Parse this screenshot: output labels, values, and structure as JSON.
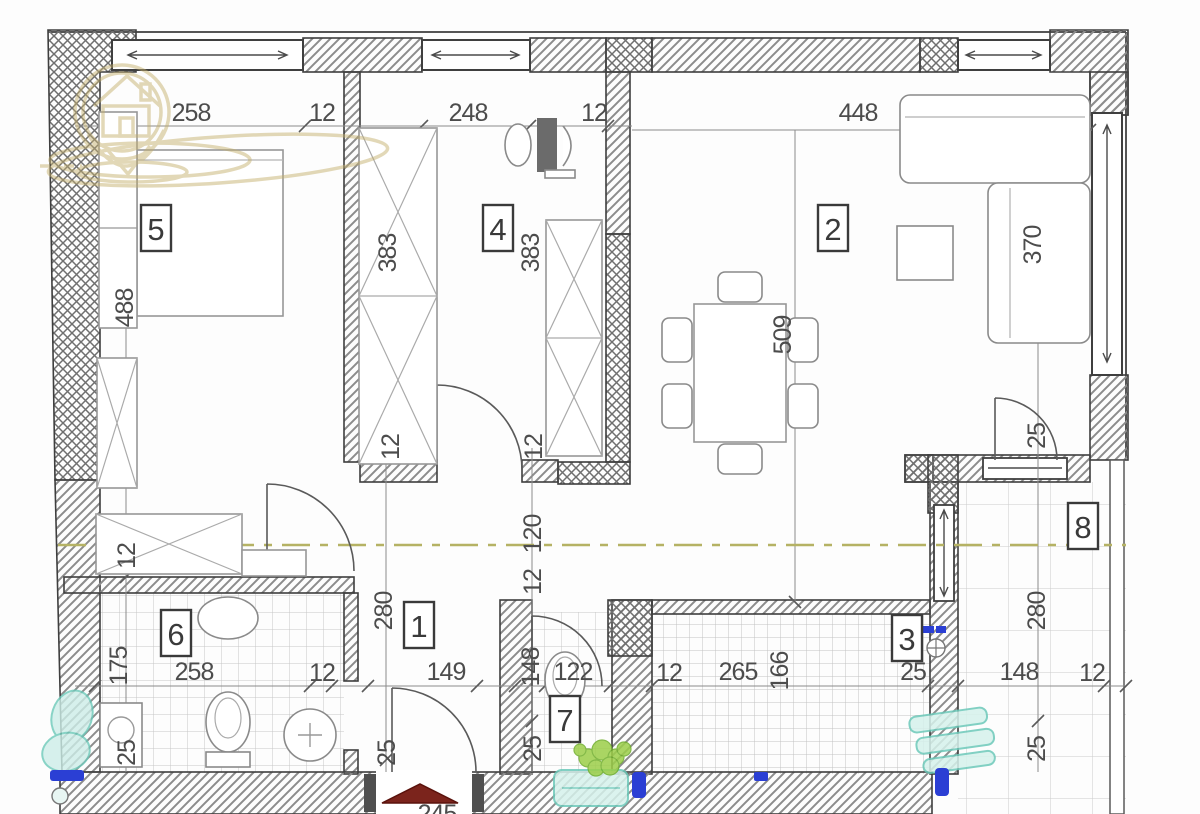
{
  "plan": {
    "kind": "apartment-floor-plan",
    "entrance_label": "245",
    "centerline_color": "#b5b264",
    "wall_line_color": "#3f3f3f",
    "logo_color": "#c3ae6b",
    "entrance_marker_color": "#7b241c",
    "accent_teal": "#6cc9b9",
    "accent_green": "#9ccf49",
    "accent_blue": "#2b3fd4"
  },
  "rooms": {
    "r1": {
      "n": "1"
    },
    "r2": {
      "n": "2"
    },
    "r3": {
      "n": "3"
    },
    "r4": {
      "n": "4"
    },
    "r5": {
      "n": "5"
    },
    "r6": {
      "n": "6"
    },
    "r7": {
      "n": "7"
    },
    "r8": {
      "n": "8"
    }
  },
  "dims": [
    {
      "v": "258"
    },
    {
      "v": "12"
    },
    {
      "v": "248"
    },
    {
      "v": "12"
    },
    {
      "v": "448"
    },
    {
      "v": "488"
    },
    {
      "v": "383"
    },
    {
      "v": "383"
    },
    {
      "v": "370"
    },
    {
      "v": "509"
    },
    {
      "v": "12"
    },
    {
      "v": "12"
    },
    {
      "v": "25"
    },
    {
      "v": "12"
    },
    {
      "v": "120"
    },
    {
      "v": "12"
    },
    {
      "v": "280"
    },
    {
      "v": "280"
    },
    {
      "v": "175"
    },
    {
      "v": "148"
    },
    {
      "v": "166"
    },
    {
      "v": "258"
    },
    {
      "v": "12"
    },
    {
      "v": "149"
    },
    {
      "v": "122"
    },
    {
      "v": "12"
    },
    {
      "v": "265"
    },
    {
      "v": "25"
    },
    {
      "v": "148"
    },
    {
      "v": "12"
    },
    {
      "v": "25"
    },
    {
      "v": "25"
    },
    {
      "v": "25"
    },
    {
      "v": "25"
    }
  ]
}
